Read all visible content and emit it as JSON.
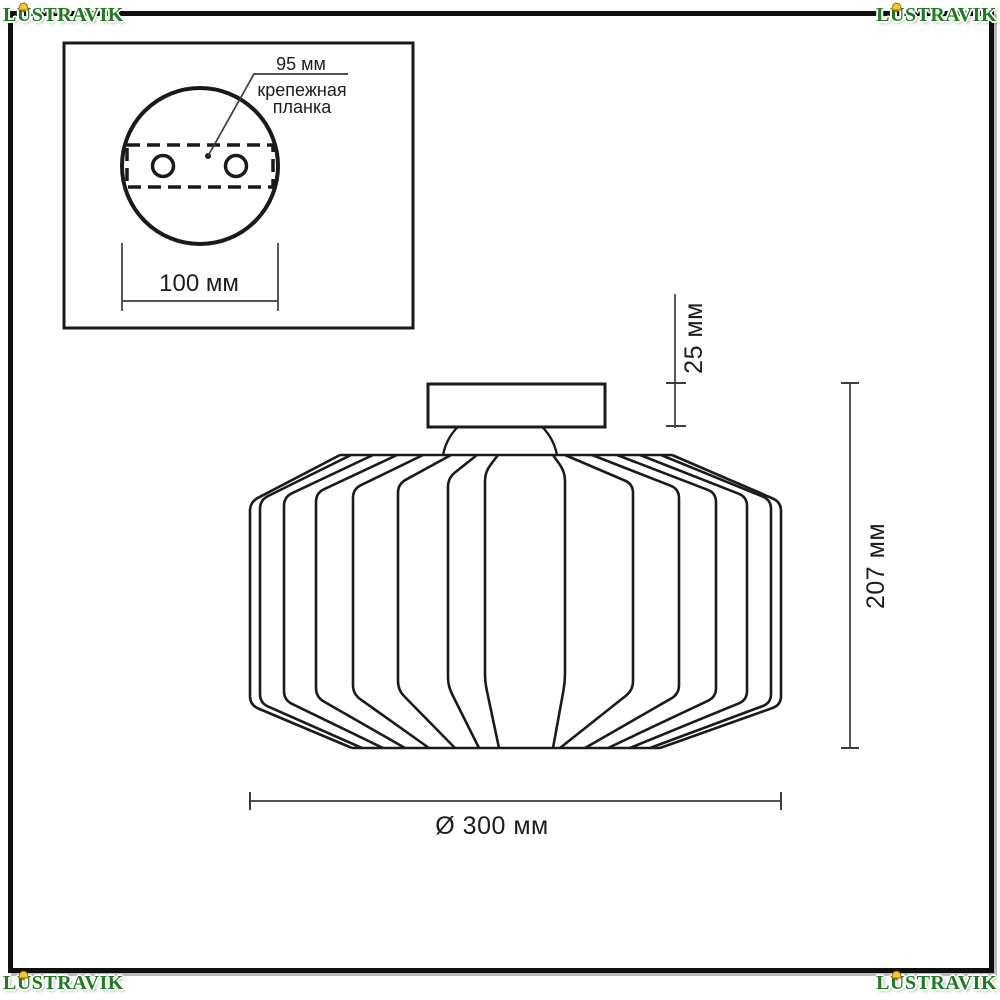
{
  "watermark": {
    "text": "LUSTRAVIK"
  },
  "inset": {
    "dim_95": "95 мм",
    "plate_label_line1": "крепежная",
    "plate_label_line2": "планка",
    "dim_100": "100 мм"
  },
  "main": {
    "dim_25": "25 мм",
    "dim_207": "207 мм",
    "dim_300": "Ø 300 мм"
  }
}
